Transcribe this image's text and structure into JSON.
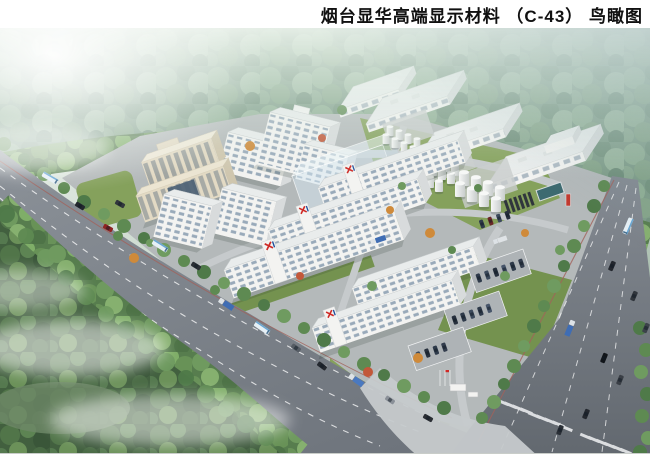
{
  "header": {
    "title": "烟台显华高端显示材料 （C-43） 鸟瞰图"
  },
  "palette": {
    "page_bg": "#ffffff",
    "title_color": "#111111",
    "haze": "#eef4ee",
    "forest_far": "#7e9c88",
    "forest_near": "#577d4e",
    "forest_dark": "#42603f",
    "tree_green_1": "#5e8a52",
    "tree_green_2": "#4f7a49",
    "tree_green_3": "#6f9b60",
    "autumn_orange": "#cf8a3a",
    "autumn_red": "#c2583a",
    "road": "#7c828a",
    "road_dark": "#686e76",
    "inner_road": "#c6cacc",
    "pad": "#b4b9ba",
    "lawn": "#85a15c",
    "lawn_dark": "#74924f",
    "lane_white": "#ffffff",
    "median_red": "#a2615a",
    "bldg_white": "#f3f3f1",
    "bldg_side": "#d8dbdc",
    "roof": "#e9ecec",
    "window_glass": "#8fa2b4",
    "beige": "#e3dac4",
    "beige_side": "#cfc6ae",
    "glass_blue": "#4d6275",
    "tank": "#f4f5f4",
    "logo_red": "#cf2a26",
    "logo_blue": "#1f4e9c",
    "pool": "#3d6a70",
    "mist": "#ffffff"
  },
  "scene": {
    "type": "aerial bird's-eye architectural rendering of an industrial park",
    "elements": [
      "hazy-forest-backdrop",
      "misty-forest-foreground",
      "left-highway",
      "right-road",
      "intersection-crosswalks",
      "campus-ground",
      "office-towers",
      "dormitory-slabs",
      "admin-building",
      "translucent-planned-building",
      "warehouses",
      "storage-tank-clusters",
      "water-treatment-area",
      "parking-lots",
      "entrance-gate",
      "roadside-tree-rows",
      "ornamental-trees",
      "road-vehicles",
      "mist-patches"
    ],
    "building_logo": "red X mark with blue stroke on rooftop stair towers",
    "vehicle_types": [
      "bus",
      "car",
      "container-truck"
    ]
  }
}
